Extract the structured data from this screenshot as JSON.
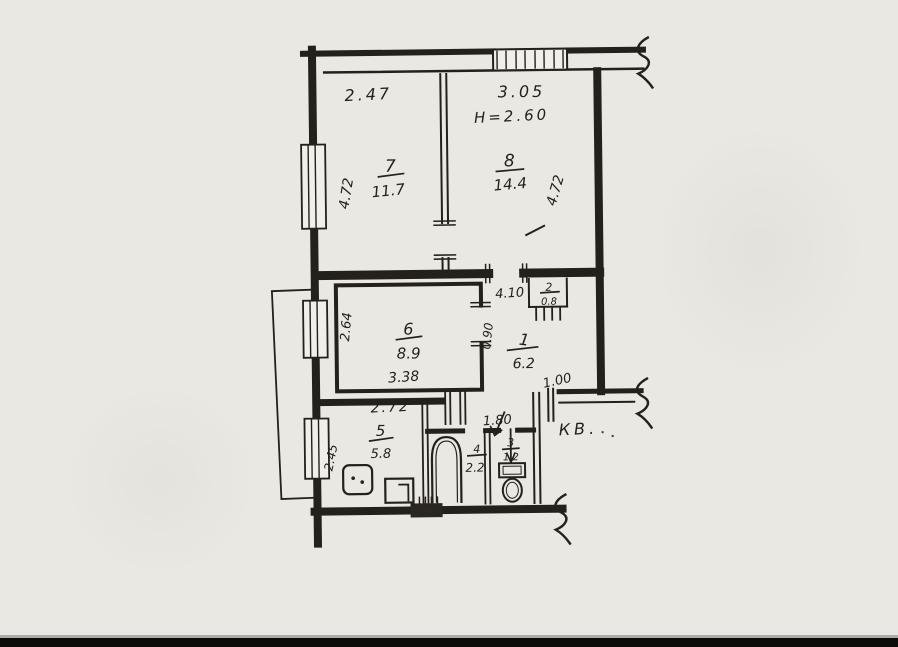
{
  "plan": {
    "rooms": {
      "r7": {
        "number": "7",
        "area": "11.7"
      },
      "r8": {
        "number": "8",
        "area": "14.4"
      },
      "r6": {
        "number": "6",
        "area": "8.9"
      },
      "r1": {
        "number": "1",
        "area": "6.2"
      },
      "r2": {
        "number": "2",
        "area": "0.8"
      },
      "r5": {
        "number": "5",
        "area": "5.8"
      },
      "r4": {
        "number": "4",
        "area": "2.2"
      },
      "r3": {
        "number": "3",
        "area": "1.2"
      }
    },
    "dimensions": {
      "room7_width": "2.47",
      "room8_width": "3.05",
      "ceiling_height": "H=2.60",
      "left_depth": "4.72",
      "right_depth": "4.72",
      "room6_depth": "2.64",
      "room6_width": "3.38",
      "corridor_length": "4.10",
      "room6_door_width": "0.90",
      "entry_door_width": "1.00",
      "kitchen_width": "2.72",
      "kitchen_depth": "2.45",
      "bath_entry_width": "1.80"
    },
    "annotations": {
      "apartment_label": "КВ."
    },
    "colors": {
      "ink": "#24211c",
      "paper": "#eae8e3"
    }
  }
}
